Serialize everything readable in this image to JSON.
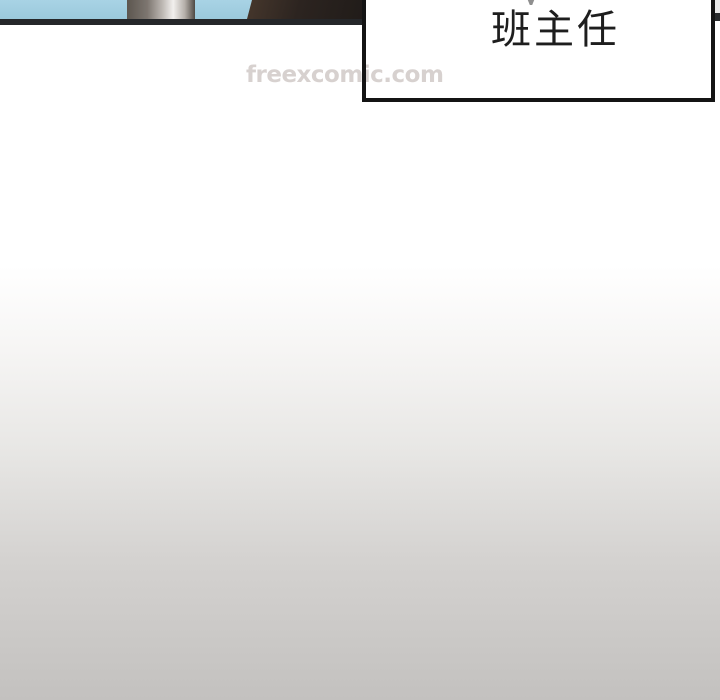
{
  "comic": {
    "speech_bubble": {
      "text": "班主任",
      "fill_color": "#ffffff",
      "border_color": "#141414",
      "text_color": "#1e1e1e"
    },
    "watermark": {
      "text": "freexcomic.com",
      "color": "#d7d1cf"
    },
    "panel": {
      "sky_color": "#a8d3e5",
      "pole_highlight_color": "#f2f0ee",
      "figure_color": "#2c2420",
      "edge_line_color": "#25272a"
    },
    "page": {
      "gradient_top_color": "#ffffff",
      "gradient_bottom_color": "#c3c1bf"
    }
  }
}
